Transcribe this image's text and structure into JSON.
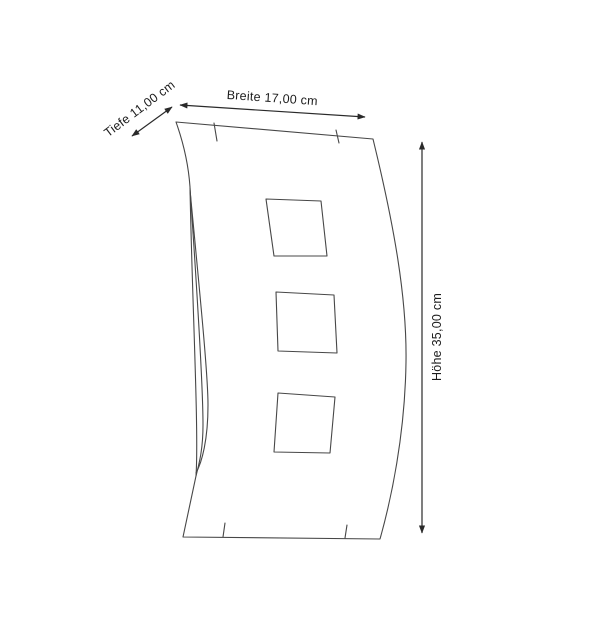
{
  "diagram": {
    "kind": "product-dimension-line-drawing",
    "dimensions": {
      "depth": {
        "label": "Tiefe 11,00 cm",
        "name": "Tiefe",
        "value_cm": 11.0,
        "unit": "cm"
      },
      "width": {
        "label": "Breite 17,00 cm",
        "name": "Breite",
        "value_cm": 17.0,
        "unit": "cm"
      },
      "height": {
        "label": "Höhe 35,00 cm",
        "name": "Höhe",
        "value_cm": 35.0,
        "unit": "cm"
      }
    },
    "cutouts": {
      "count": 3,
      "shape": "square"
    },
    "colors": {
      "background": "#ffffff",
      "line": "#474747",
      "arrow": "#2a2a2a",
      "text": "#1c1c1c"
    }
  }
}
